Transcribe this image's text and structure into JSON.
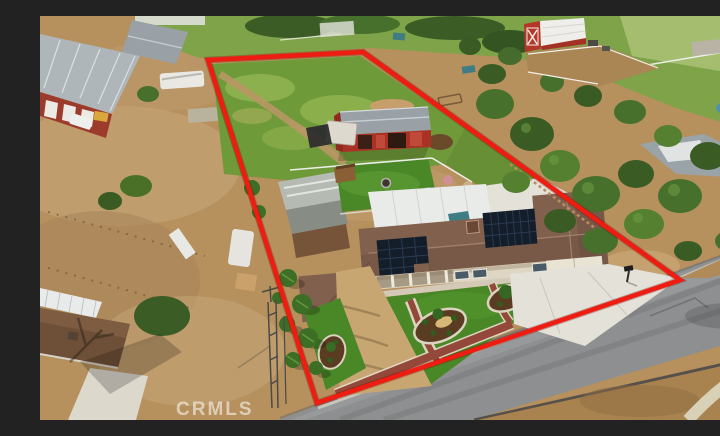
{
  "meta": {
    "type": "aerial-drone-photograph",
    "subject": "rural residential property listing photo with red parcel outline",
    "width_px": 720,
    "height_px": 404
  },
  "watermark": {
    "text": "CRMLS"
  },
  "boundary": {
    "points": "168,44 323,36 640,264 277,387",
    "description": "red property-line outline drawn over the photo"
  },
  "palette": {
    "boundary_red": "#ee1c11",
    "dirt_tan": "#b6905d",
    "pasture_green": "#6f9a3a",
    "turf_green": "#498727",
    "road_gray": "#8d8f90",
    "roof_brown": "#82604e",
    "solar_panel": "#141e2a",
    "concrete": "#e3e1d8",
    "stable_red": "#aa3126",
    "barn_red": "#b5372a",
    "tree_green": "#47702c",
    "mulch_brown": "#5a3c22",
    "brick_path": "#93483a",
    "gravel_tan": "#c8a672",
    "patio_cover_white": "#e9ebe9"
  },
  "features": [
    "red outlined parcel with green pasture at rear",
    "red horse barn with gray roof mid-parcel",
    "single-story ranch house with brown roof and two rooftop solar arrays",
    "white patio cover behind house",
    "front yard with turf, three curbed mulch planting beds and brick walkways",
    "decomposed-granite side driveway lined with palm trees",
    "concrete driveway and apron to garage",
    "asphalt road along the front of the parcel",
    "lattice antenna tower near front-left corner",
    "neighboring red gambrel barn with white roof (top right)",
    "neighboring industrial metal buildings, RVs and trailers (left)",
    "neighboring house with pool among mature trees (right)",
    "dirt lots at left and beyond the road",
    "CRMLS watermark at bottom left"
  ]
}
